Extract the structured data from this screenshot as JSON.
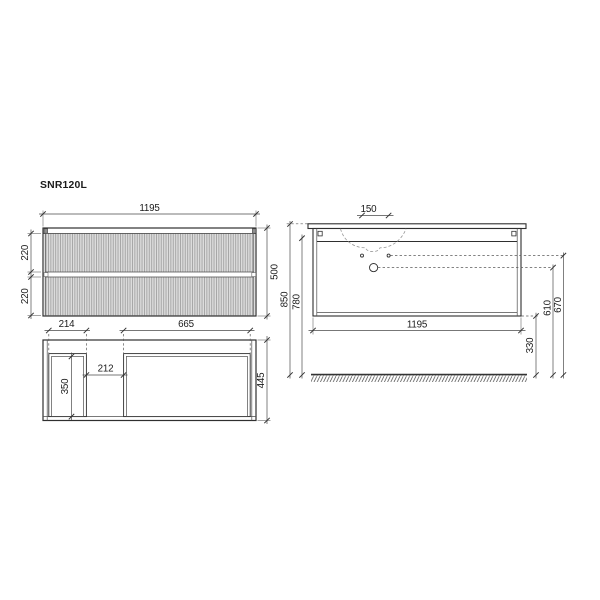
{
  "title": "SNR120L",
  "front_view": {
    "width": "1195",
    "height": "500",
    "top_drawer_height": "220",
    "bottom_drawer_height": "220"
  },
  "plan_view": {
    "left_compartment_width": "214",
    "right_compartment_width": "665",
    "middle_gap_width": "212",
    "left_compartment_depth": "350",
    "overall_depth": "445"
  },
  "side_view": {
    "tap_hole_spacing": "150",
    "overall_height": "850",
    "underside_height": "780",
    "cabinet_width": "1195",
    "floor_clearance": "330",
    "outlet_height": "610",
    "tap_line_height": "670"
  },
  "colors": {
    "line": "#2f2f2f",
    "dimension": "#4a4a4a",
    "flute_fill": "#dcdcdc",
    "flute_stripe": "#a2a2a2",
    "background": "#ffffff"
  }
}
